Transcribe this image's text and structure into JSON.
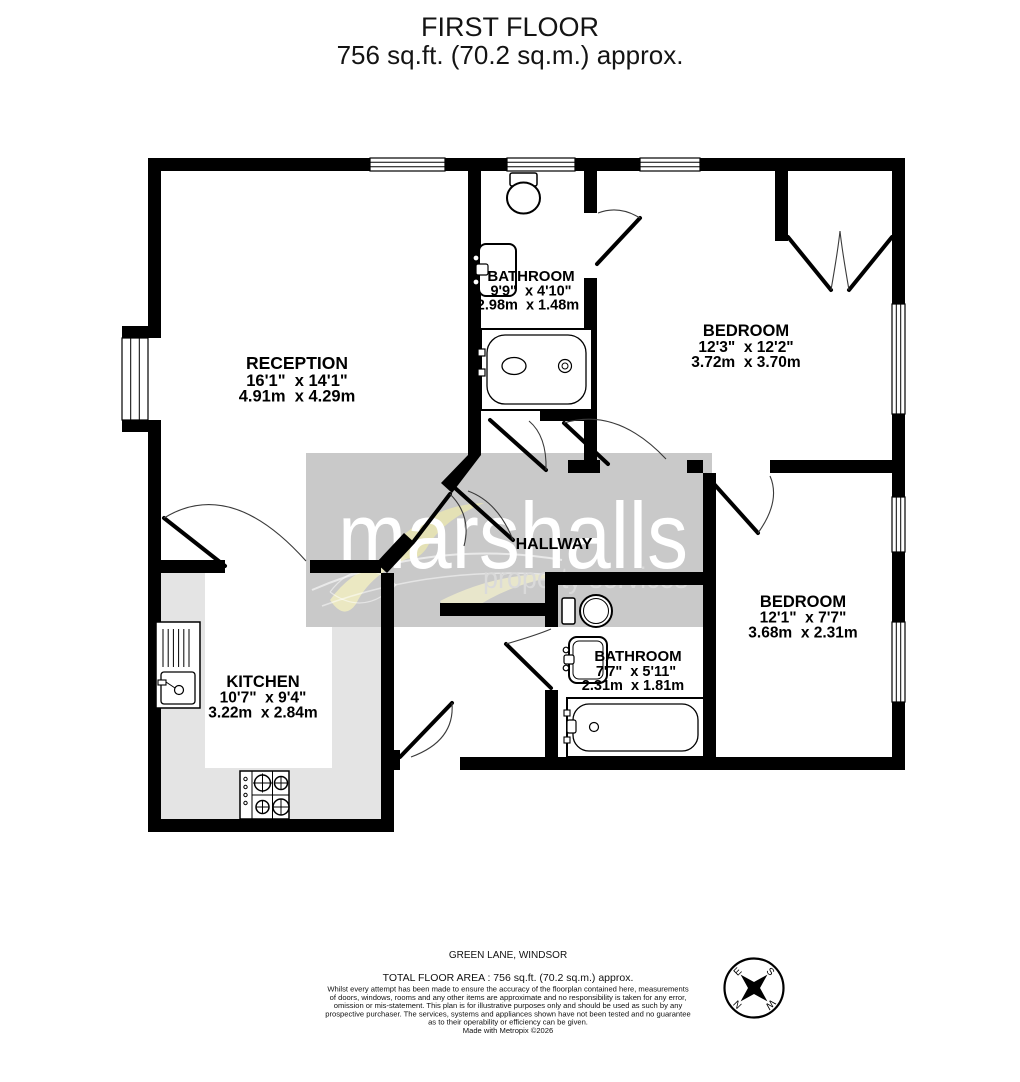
{
  "title": {
    "floor": "FIRST FLOOR",
    "area": "756 sq.ft. (70.2 sq.m.) approx."
  },
  "rooms": {
    "reception": {
      "name": "RECEPTION",
      "imperial": "16'1\"  x 14'1\"",
      "metric": "4.91m  x 4.29m"
    },
    "bathroom_top": {
      "name": "BATHROOM",
      "imperial": "9'9\"  x 4'10\"",
      "metric": "2.98m  x 1.48m"
    },
    "bedroom_top": {
      "name": "BEDROOM",
      "imperial": "12'3\"  x 12'2\"",
      "metric": "3.72m  x 3.70m"
    },
    "hallway": {
      "name": "HALLWAY"
    },
    "kitchen": {
      "name": "KITCHEN",
      "imperial": "10'7\"  x 9'4\"",
      "metric": "3.22m  x 2.84m"
    },
    "bathroom_bottom": {
      "name": "BATHROOM",
      "imperial": "7'7\"  x 5'11\"",
      "metric": "2.31m  x 1.81m"
    },
    "bedroom_bottom": {
      "name": "BEDROOM",
      "imperial": "12'1\"  x 7'7\"",
      "metric": "3.68m  x 2.31m"
    }
  },
  "watermark": {
    "brand": "marshalls",
    "tagline": "property services"
  },
  "compass": {
    "north": "N",
    "east": "E",
    "south": "S",
    "west": "W"
  },
  "footer": {
    "address": "GREEN LANE, WINDSOR",
    "total_area": "TOTAL FLOOR AREA : 756 sq.ft. (70.2 sq.m.) approx.",
    "disclaimer_lines": [
      "Whilst every attempt has been made to ensure the accuracy of the floorplan contained here, measurements",
      "of doors, windows, rooms and any other items are approximate and no responsibility is taken for any error,",
      "omission or mis-statement. This plan is for illustrative purposes only and should be used as such by any",
      "prospective purchaser. The services, systems and appliances shown have not been tested and no guarantee",
      "as to their operability or efficiency can be given."
    ],
    "credit": "Made with Metropix ©2026"
  },
  "colors": {
    "wall": "#000000",
    "counter": "#e4e4e4",
    "watermark_box": "#c9c9c9",
    "swirl": "#edeac2"
  }
}
